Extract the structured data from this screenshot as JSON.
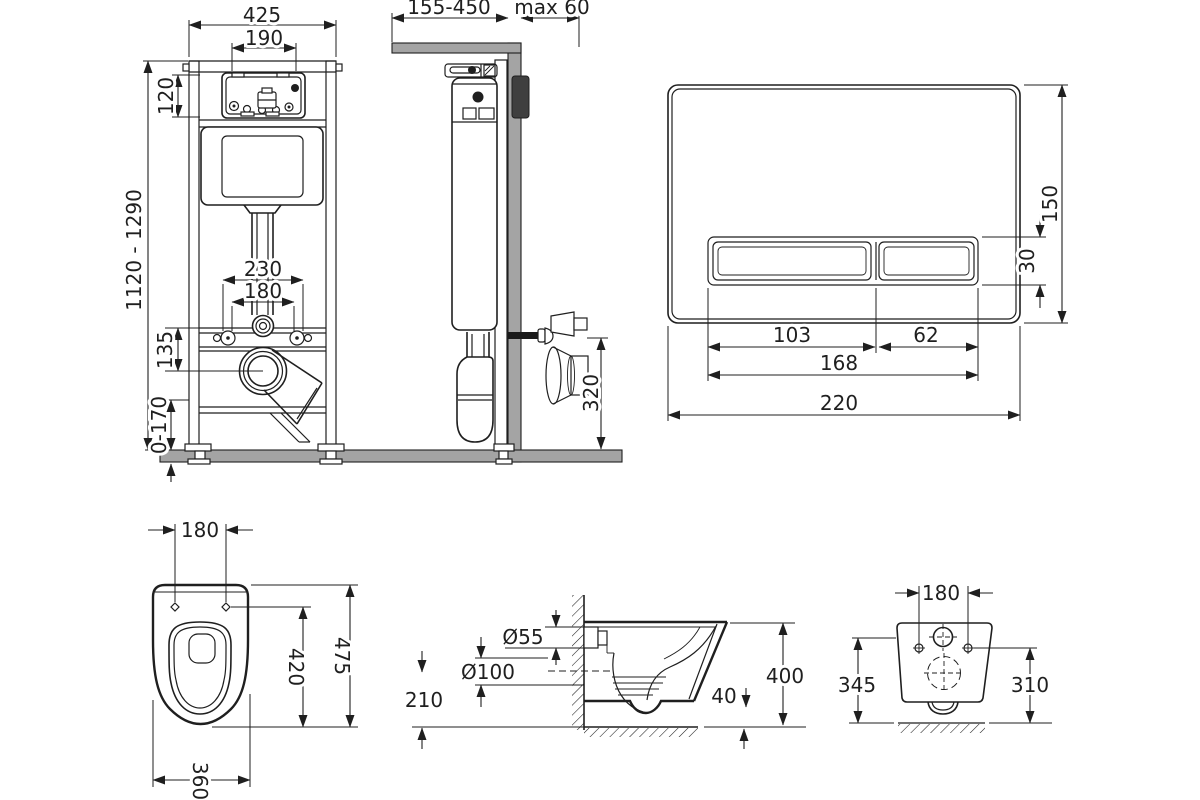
{
  "drawing": {
    "type": "installation-dimensions-technical-drawing",
    "background_color": "#ffffff",
    "line_color": "#1f1f1f",
    "wall_fill_color": "#a4a4a4",
    "views": {
      "frame_front": {
        "label": "concealed-cistern-frame-front-view",
        "dims": {
          "frame_width": "425",
          "opening_width": "190",
          "opening_height": "120",
          "install_height": "1120 - 1290",
          "fixing_outer": "230",
          "fixing_inner": "180",
          "outlet_drop": "135",
          "leg_range": "0-170"
        }
      },
      "frame_side": {
        "label": "concealed-cistern-frame-side-view",
        "dims": {
          "depth_range": "155-450",
          "wall_max": "max 60",
          "outlet_height": "320"
        }
      },
      "flush_plate": {
        "label": "flush-plate-front-view",
        "dims": {
          "plate_height": "150",
          "button_height": "30",
          "big_button_width": "103",
          "small_button_width": "62",
          "buttons_total_width": "168",
          "plate_width": "220"
        }
      },
      "bowl_top": {
        "label": "wall-hung-bowl-top-view",
        "dims": {
          "hole_spacing": "180",
          "inner_depth": "420",
          "total_depth": "475",
          "bowl_width": "360"
        }
      },
      "bowl_side": {
        "label": "wall-hung-bowl-side-view",
        "dims": {
          "inlet_diameter": "Ø55",
          "outlet_diameter": "Ø100",
          "outlet_center_height": "210",
          "rim_drop": "40",
          "bowl_height": "400"
        }
      },
      "bowl_rear": {
        "label": "wall-hung-bowl-rear-view",
        "dims": {
          "hole_spacing": "180",
          "height_left": "345",
          "height_right": "310"
        }
      }
    }
  }
}
